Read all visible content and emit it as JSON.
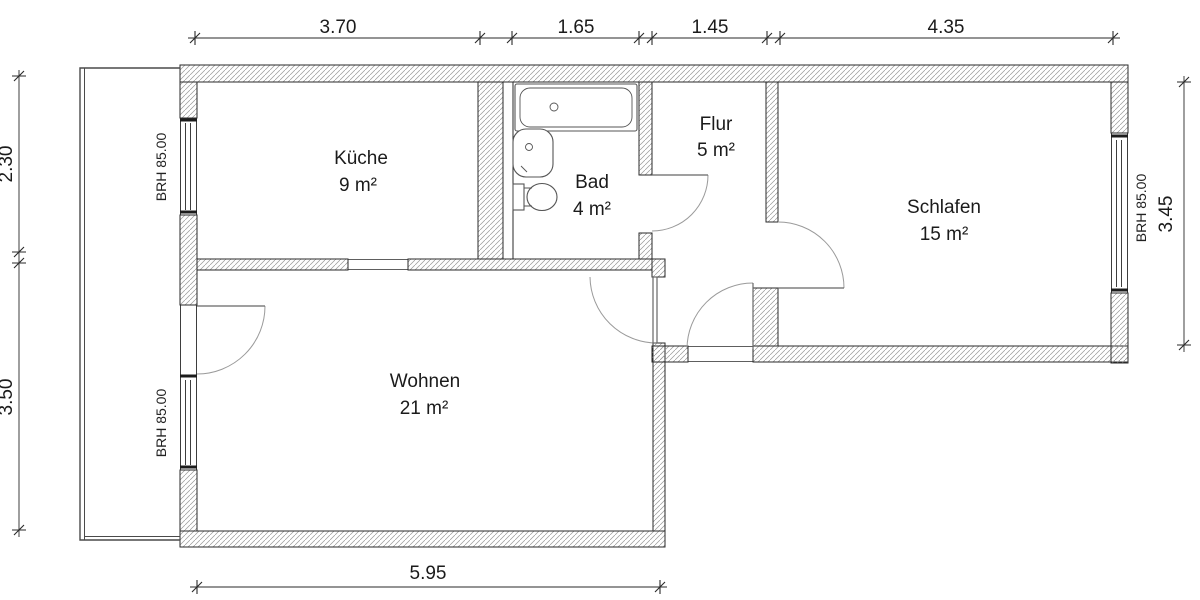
{
  "rooms": [
    {
      "name": "Küche",
      "area": "9 m²"
    },
    {
      "name": "Bad",
      "area": "4 m²"
    },
    {
      "name": "Flur",
      "area": "5 m²"
    },
    {
      "name": "Schlafen",
      "area": "15 m²"
    },
    {
      "name": "Wohnen",
      "area": "21 m²"
    }
  ],
  "dims": {
    "top": [
      "3.70",
      "1.65",
      "1.45",
      "4.35"
    ],
    "left": [
      "2.30",
      "3.50"
    ],
    "right": [
      "3.45"
    ],
    "bottom": [
      "5.95"
    ]
  },
  "sills": {
    "kueche": "BRH 85.00",
    "wohnen": "BRH 85.00",
    "schlafen": "BRH 85.00"
  },
  "colors": {
    "line": "#2a2a2a",
    "hatch": "#999999",
    "door_arc": "#9a9a9a",
    "background": "#ffffff"
  }
}
